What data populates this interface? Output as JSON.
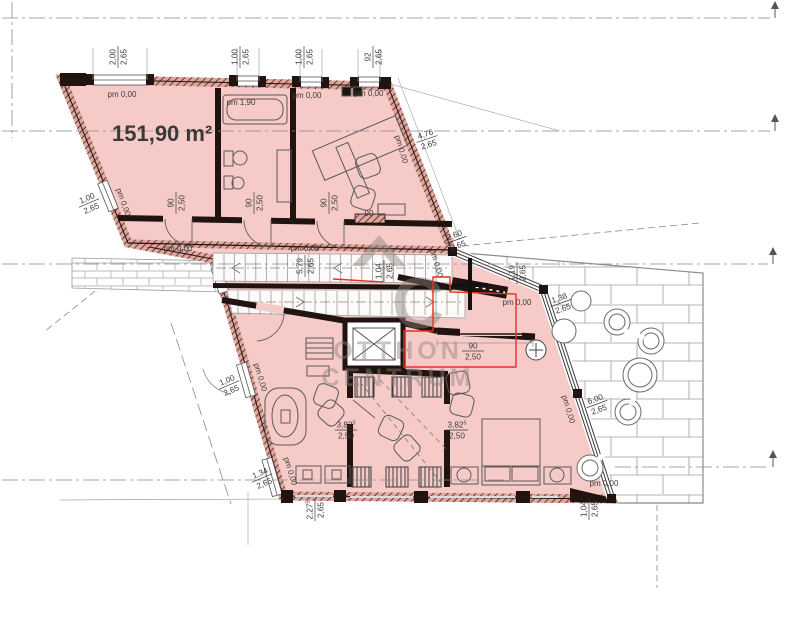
{
  "area_label": "151,90 m²",
  "watermark": {
    "monogram": "C",
    "line1": "OTTHON",
    "line2": "CENTRUM"
  },
  "colors": {
    "room_fill": "#f5cac7",
    "wall_dark": "#201310",
    "hatch_line": "#6e352c",
    "red_annotation": "#e63028",
    "dim_text": "#3d3d3d",
    "watermark_gray": "#8e837e"
  },
  "annotations": {
    "fractions": [
      {
        "top": "2,00",
        "bottom": "2,65",
        "x": 118,
        "y": 57,
        "rot": -90
      },
      {
        "top": "1,00",
        "bottom": "2,65",
        "x": 240,
        "y": 57,
        "rot": -90
      },
      {
        "top": "1,00",
        "bottom": "2,65",
        "x": 304,
        "y": 57,
        "rot": -90
      },
      {
        "top": "92",
        "bottom": "2,65",
        "x": 373,
        "y": 57,
        "rot": -90
      },
      {
        "top": "1,00",
        "bottom": "2,65",
        "x": 89,
        "y": 203,
        "rot": -23
      },
      {
        "top": "4,76",
        "bottom": "2,65",
        "x": 427,
        "y": 139,
        "rot": -18
      },
      {
        "top": "5,79",
        "bottom": "2,65",
        "x": 305,
        "y": 266,
        "rot": -90
      },
      {
        "top": "1,04",
        "bottom": "2,65",
        "x": 384,
        "y": 271,
        "rot": -90
      },
      {
        "top": "2,60",
        "bottom": "2,65",
        "x": 456,
        "y": 240,
        "rot": -20
      },
      {
        "top": "1,19",
        "bottom": "2,65",
        "x": 517,
        "y": 273,
        "rot": -90
      },
      {
        "top": "1,38",
        "bottom": "2,65",
        "x": 561,
        "y": 303,
        "rot": -20
      },
      {
        "top": "6,00",
        "bottom": "2,65",
        "x": 597,
        "y": 404,
        "rot": -20
      },
      {
        "top": "3,82",
        "sup": "5",
        "bottom": "2,50",
        "x": 346,
        "y": 430,
        "rot": 0
      },
      {
        "top": "3,82",
        "sup": "5",
        "bottom": "2,50",
        "x": 457,
        "y": 430,
        "rot": 0
      },
      {
        "top": "1,00",
        "bottom": "2,65",
        "x": 229,
        "y": 385,
        "rot": -23
      },
      {
        "top": "1,34",
        "bottom": "2,65",
        "x": 262,
        "y": 478,
        "rot": -23
      },
      {
        "top": "2,27",
        "sup": "5",
        "bottom": "2,65",
        "x": 315,
        "y": 510,
        "rot": -90
      },
      {
        "top": "1,04",
        "bottom": "2,65",
        "x": 589,
        "y": 509,
        "rot": -90
      },
      {
        "top": "90",
        "bottom": "2,50",
        "x": 176,
        "y": 203,
        "rot": -90
      },
      {
        "top": "90",
        "bottom": "2,50",
        "x": 254,
        "y": 203,
        "rot": -90
      },
      {
        "top": "90",
        "bottom": "2,50",
        "x": 329,
        "y": 203,
        "rot": -90
      },
      {
        "top": "90",
        "bottom": "2,50",
        "x": 473,
        "y": 351,
        "rot": 0
      }
    ],
    "levels": [
      {
        "s": "pm 0,00",
        "x": 122,
        "y": 97,
        "rot": 0
      },
      {
        "s": "pm 1,90",
        "x": 241,
        "y": 105,
        "rot": 0
      },
      {
        "s": "pm 0,00",
        "x": 307,
        "y": 98,
        "rot": 0
      },
      {
        "s": "pm 0,00",
        "x": 369,
        "y": 96,
        "rot": 0
      },
      {
        "s": "pm 0,00",
        "x": 178,
        "y": 251,
        "rot": 0
      },
      {
        "s": "pm 0,00",
        "x": 305,
        "y": 251,
        "rot": 0
      },
      {
        "s": "pm 0,00",
        "x": 517,
        "y": 305,
        "rot": 0
      },
      {
        "s": "pm 0,00",
        "x": 399,
        "y": 150,
        "rot": 73
      },
      {
        "s": "pm 0,00",
        "x": 121,
        "y": 203,
        "rot": 70
      },
      {
        "s": "pm 0,00",
        "x": 434,
        "y": 264,
        "rot": 73
      },
      {
        "s": "pm 0,00",
        "x": 258,
        "y": 378,
        "rot": 73
      },
      {
        "s": "pm 0,00",
        "x": 288,
        "y": 472,
        "rot": 73
      },
      {
        "s": "pm 0,00",
        "x": 566,
        "y": 410,
        "rot": 73
      },
      {
        "s": "pm 0,00",
        "x": 604,
        "y": 486,
        "rot": 0
      },
      {
        "s": "90",
        "x": 369,
        "y": 216,
        "rot": 0
      }
    ]
  }
}
